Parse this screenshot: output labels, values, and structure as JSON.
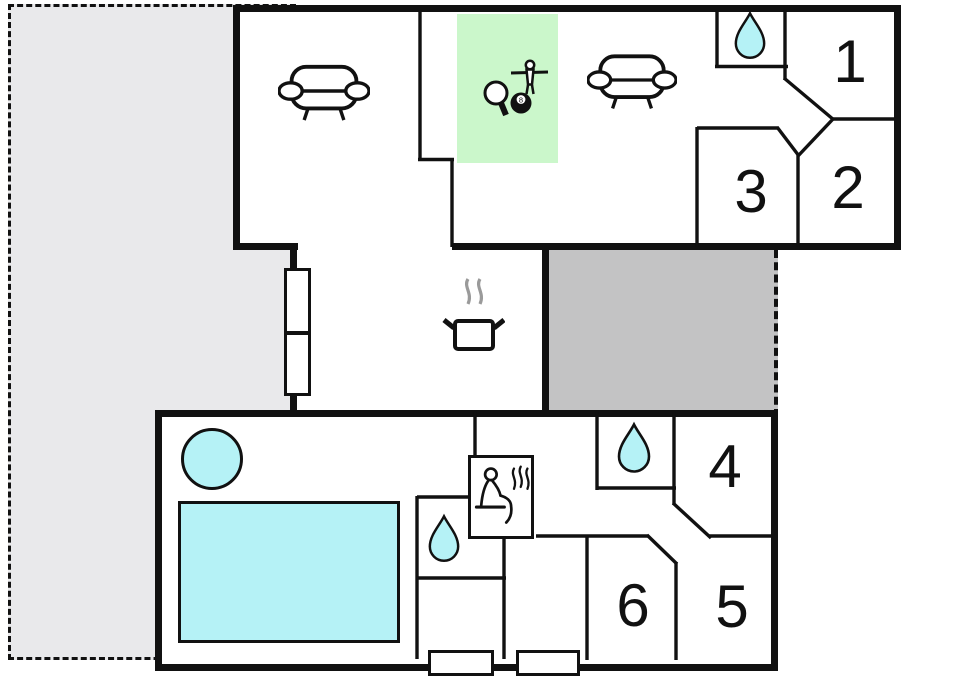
{
  "document": {
    "type": "floor-plan"
  },
  "rooms": [
    {
      "number": "1"
    },
    {
      "number": "2"
    },
    {
      "number": "3"
    },
    {
      "number": "4"
    },
    {
      "number": "5"
    },
    {
      "number": "6"
    }
  ],
  "labels": {
    "pool_ball": "8"
  },
  "icons": {
    "sofa": "sofa-icon",
    "games": "games-icon (table-tennis paddle, billiard 8-ball, foosball player)",
    "stove": "stove-pot-with-steam-icon",
    "water": "water-drop-icon",
    "sauna": "sauna-person-icon"
  },
  "colors": {
    "wall": "#111111",
    "terrace": "#e9e9eb",
    "covered_room": "#c3c3c4",
    "water": "#b5f2f6",
    "games_area": "#cbf7cb",
    "steam": "#9a9a9a",
    "paper": "#ffffff"
  }
}
